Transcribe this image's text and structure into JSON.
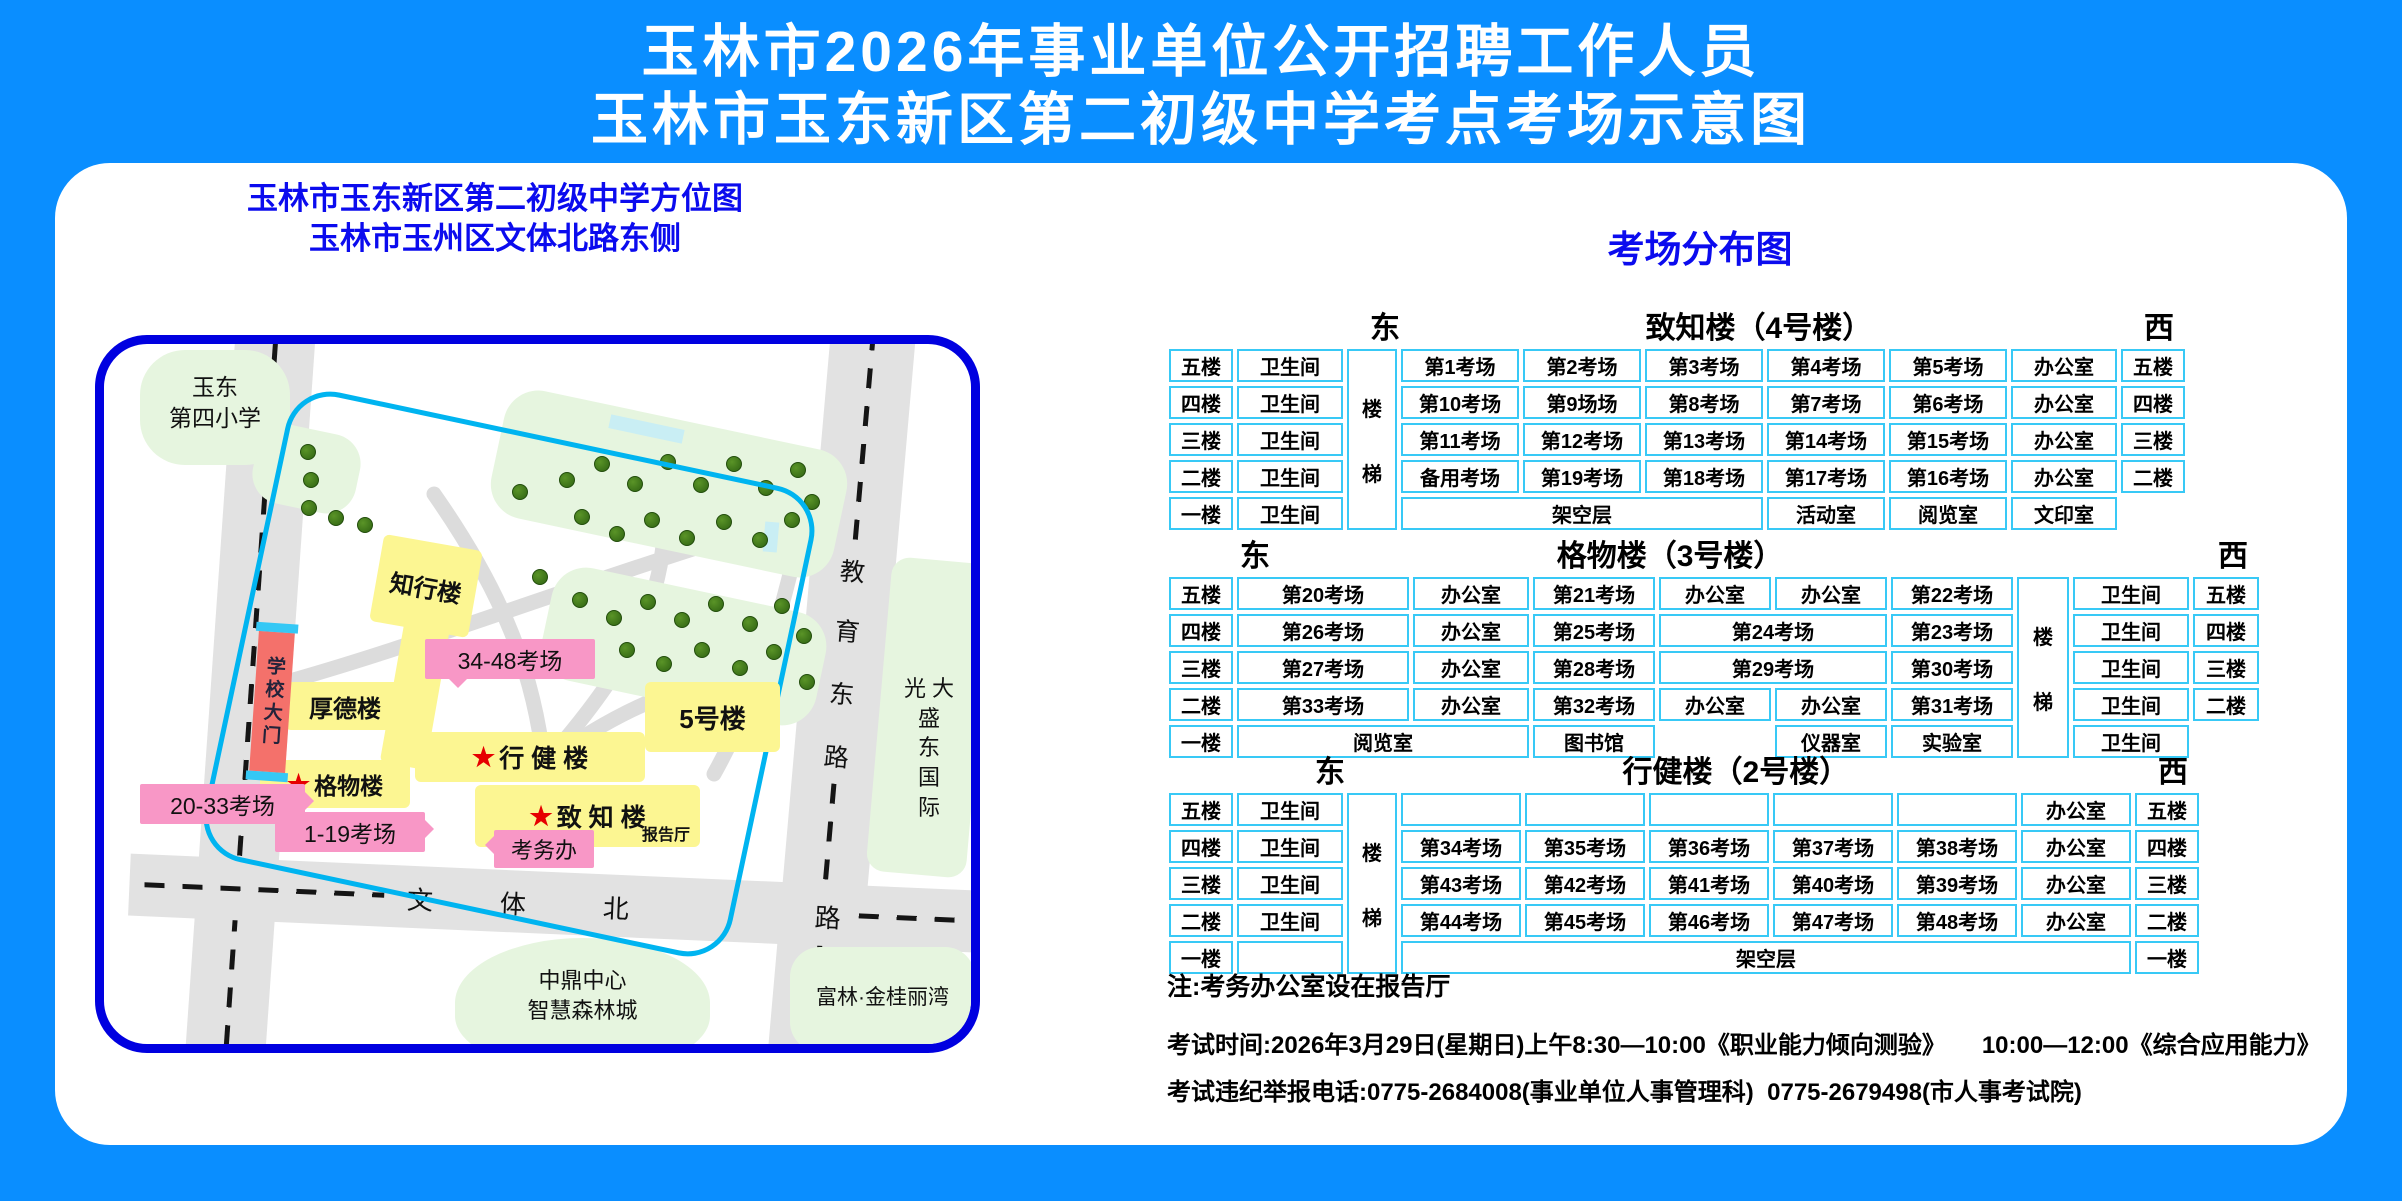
{
  "title": {
    "line1": "玉林市2026年事业单位公开招聘工作人员",
    "line2": "玉林市玉东新区第二初级中学考点考场示意图"
  },
  "map": {
    "subtitle1": "玉林市玉东新区第二初级中学方位图",
    "subtitle2": "玉林市玉州区文体北路东侧",
    "school_nw": {
      "line1": "玉东",
      "line2": "第四小学"
    },
    "gate": "学校大门",
    "buildings": {
      "zhixing": "知行楼",
      "houde": "厚德楼",
      "xingjian": "行 健 楼",
      "no5": "5号楼",
      "gewu": "格物楼",
      "zhizhi": "致 知 楼",
      "baogaoting": "报告厅"
    },
    "tags": {
      "t3448": "34-48考场",
      "t2033": "20-33考场",
      "t119": "1-19考场",
      "kaowu": "考务办"
    },
    "road_bottom_chars": [
      "文",
      "体",
      "北",
      "路"
    ],
    "road_right_chars": [
      "教",
      "育",
      "东",
      "路"
    ],
    "places": {
      "guangda_lines": [
        "光 大",
        "盛",
        "东",
        "国",
        "际"
      ],
      "zhongding1": "中鼎中心",
      "zhongding2": "智慧森林城",
      "fulin": "富林·金桂丽湾"
    }
  },
  "panel": {
    "title": "考场分布图",
    "tables": [
      {
        "name": "致知楼（4号楼）",
        "east": "东",
        "west": "西",
        "stair": "楼梯",
        "stair_col": 2,
        "east_left": 205,
        "name_center": "58%",
        "widths": [
          64,
          106,
          50,
          118,
          118,
          118,
          118,
          118,
          106,
          64
        ],
        "rows": [
          [
            {
              "t": "五楼"
            },
            {
              "t": "卫生间"
            },
            {
              "t": "第1考场"
            },
            {
              "t": "第2考场"
            },
            {
              "t": "第3考场"
            },
            {
              "t": "第4考场"
            },
            {
              "t": "第5考场"
            },
            {
              "t": "办公室"
            },
            {
              "t": "五楼"
            }
          ],
          [
            {
              "t": "四楼"
            },
            {
              "t": "卫生间"
            },
            {
              "t": "第10考场"
            },
            {
              "t": "第9场场"
            },
            {
              "t": "第8考场"
            },
            {
              "t": "第7考场"
            },
            {
              "t": "第6考场"
            },
            {
              "t": "办公室"
            },
            {
              "t": "四楼"
            }
          ],
          [
            {
              "t": "三楼"
            },
            {
              "t": "卫生间"
            },
            {
              "t": "第11考场"
            },
            {
              "t": "第12考场"
            },
            {
              "t": "第13考场"
            },
            {
              "t": "第14考场"
            },
            {
              "t": "第15考场"
            },
            {
              "t": "办公室"
            },
            {
              "t": "三楼"
            }
          ],
          [
            {
              "t": "二楼"
            },
            {
              "t": "卫生间"
            },
            {
              "t": "备用考场"
            },
            {
              "t": "第19考场"
            },
            {
              "t": "第18考场"
            },
            {
              "t": "第17考场"
            },
            {
              "t": "第16考场"
            },
            {
              "t": "办公室"
            },
            {
              "t": "二楼"
            }
          ],
          [
            {
              "t": "一楼"
            },
            {
              "t": "卫生间"
            },
            {
              "t": "架空层",
              "cs": 3
            },
            {
              "t": "活动室"
            },
            {
              "t": "阅览室"
            },
            {
              "t": "文印室"
            },
            {
              "t": "",
              "blank": true
            }
          ]
        ]
      },
      {
        "name": "格物楼（3号楼）",
        "east": "东",
        "west": "西",
        "stair": "楼梯",
        "stair_col": 7,
        "east_left": 75,
        "name_center": "46%",
        "widths": [
          64,
          172,
          116,
          122,
          112,
          112,
          122,
          52,
          116,
          66
        ],
        "rows": [
          [
            {
              "t": "五楼"
            },
            {
              "t": "第20考场"
            },
            {
              "t": "办公室"
            },
            {
              "t": "第21考场"
            },
            {
              "t": "办公室"
            },
            {
              "t": "办公室"
            },
            {
              "t": "第22考场"
            },
            {
              "t": "卫生间"
            },
            {
              "t": "五楼"
            }
          ],
          [
            {
              "t": "四楼"
            },
            {
              "t": "第26考场"
            },
            {
              "t": "办公室"
            },
            {
              "t": "第25考场"
            },
            {
              "t": "第24考场",
              "cs": 2
            },
            {
              "t": "第23考场"
            },
            {
              "t": "卫生间"
            },
            {
              "t": "四楼"
            }
          ],
          [
            {
              "t": "三楼"
            },
            {
              "t": "第27考场"
            },
            {
              "t": "办公室"
            },
            {
              "t": "第28考场"
            },
            {
              "t": "第29考场",
              "cs": 2
            },
            {
              "t": "第30考场"
            },
            {
              "t": "卫生间"
            },
            {
              "t": "三楼"
            }
          ],
          [
            {
              "t": "二楼"
            },
            {
              "t": "第33考场"
            },
            {
              "t": "办公室"
            },
            {
              "t": "第32考场"
            },
            {
              "t": "办公室"
            },
            {
              "t": "办公室"
            },
            {
              "t": "第31考场"
            },
            {
              "t": "卫生间"
            },
            {
              "t": "二楼"
            }
          ],
          [
            {
              "t": "一楼"
            },
            {
              "t": "阅览室",
              "cs": 2
            },
            {
              "t": "图书馆"
            },
            {
              "t": "",
              "blank": true
            },
            {
              "t": "仪器室"
            },
            {
              "t": "实验室"
            },
            {
              "t": "卫生间"
            },
            {
              "t": "",
              "blank": true
            }
          ]
        ]
      },
      {
        "name": "行健楼（2号楼）",
        "east": "东",
        "west": "西",
        "stair": "楼梯",
        "stair_col": 2,
        "east_left": 150,
        "name_center": "55%",
        "widths": [
          64,
          106,
          50,
          120,
          120,
          120,
          120,
          120,
          110,
          64
        ],
        "rows": [
          [
            {
              "t": "五楼"
            },
            {
              "t": "卫生间"
            },
            {
              "t": ""
            },
            {
              "t": ""
            },
            {
              "t": ""
            },
            {
              "t": ""
            },
            {
              "t": ""
            },
            {
              "t": "办公室"
            },
            {
              "t": "五楼"
            }
          ],
          [
            {
              "t": "四楼"
            },
            {
              "t": "卫生间"
            },
            {
              "t": "第34考场"
            },
            {
              "t": "第35考场"
            },
            {
              "t": "第36考场"
            },
            {
              "t": "第37考场"
            },
            {
              "t": "第38考场"
            },
            {
              "t": "办公室"
            },
            {
              "t": "四楼"
            }
          ],
          [
            {
              "t": "三楼"
            },
            {
              "t": "卫生间"
            },
            {
              "t": "第43考场"
            },
            {
              "t": "第42考场"
            },
            {
              "t": "第41考场"
            },
            {
              "t": "第40考场"
            },
            {
              "t": "第39考场"
            },
            {
              "t": "办公室"
            },
            {
              "t": "三楼"
            }
          ],
          [
            {
              "t": "二楼"
            },
            {
              "t": "卫生间"
            },
            {
              "t": "第44考场"
            },
            {
              "t": "第45考场"
            },
            {
              "t": "第46考场"
            },
            {
              "t": "第47考场"
            },
            {
              "t": "第48考场"
            },
            {
              "t": "办公室"
            },
            {
              "t": "二楼"
            }
          ],
          [
            {
              "t": "一楼"
            },
            {
              "t": ""
            },
            {
              "t": "架空层",
              "cs": 6
            },
            {
              "t": "一楼"
            }
          ]
        ]
      }
    ],
    "notes": [
      "注:考务办公室设在报告厅",
      "考试时间:2026年3月29日(星期日)上午8:30—10:00《职业能力倾向测验》　　10:00—12:00《综合应用能力》",
      "考试违纪举报电话:0775-2684008(事业单位人事管理科)  0775-2679498(市人事考试院)"
    ]
  },
  "colors": {
    "page_bg": "#0a8eff",
    "accent_blue": "#0b0bee",
    "map_border": "#0000e0",
    "campus_border": "#00b4f0",
    "table_border": "#38c9f6",
    "building_yellow": "#fcf692",
    "tag_pink": "#f897c6",
    "gate_red": "#f4716b",
    "road_gray": "#e2e2e2",
    "green_area": "#e6f5df"
  }
}
